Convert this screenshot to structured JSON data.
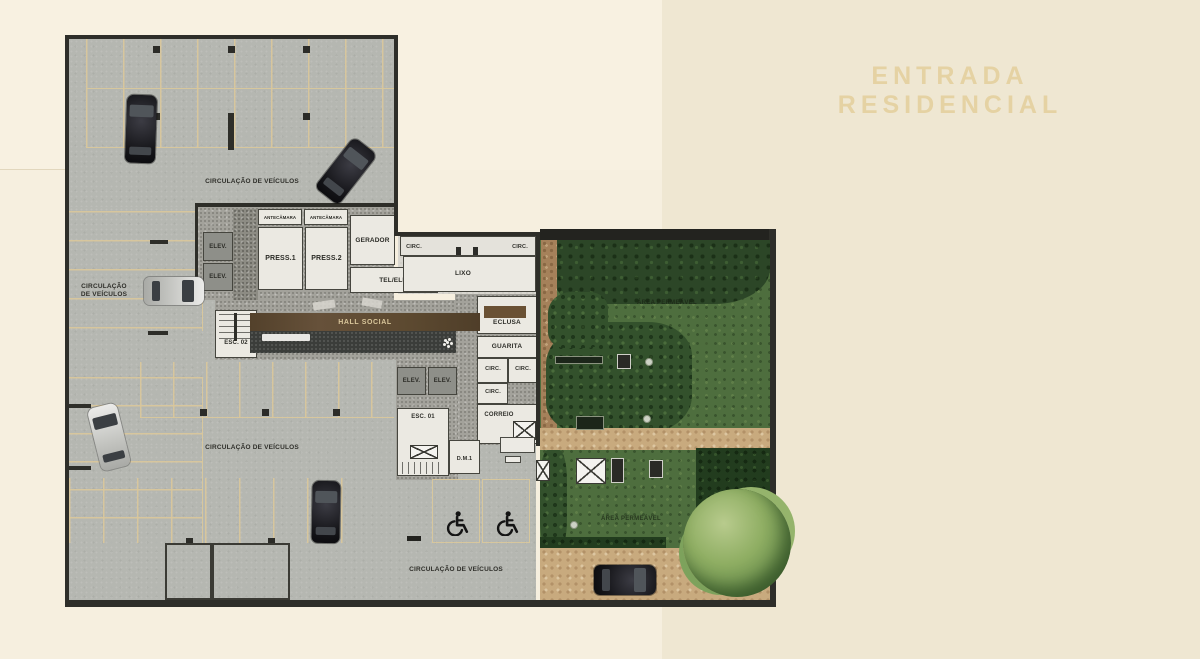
{
  "title": "ENTRADA RESIDENCIAL",
  "labels": {
    "circulacao_veiculos": "CIRCULAÇÃO DE VEÍCULOS",
    "circulacao": "CIRCULAÇÃO",
    "de_veiculos": "DE VEÍCULOS",
    "area_permeavel": "ÁREA PERMEÁVEL"
  },
  "rooms": {
    "elev": "ELEV.",
    "antecamara": "ANTECÂMARA",
    "press1": "PRESS.1",
    "press2": "PRESS.2",
    "gerador": "GERADOR",
    "tel_ele": "TEL/ELE.",
    "circ": "CIRC.",
    "lixo": "LIXO",
    "hall_social": "HALL SOCIAL",
    "esc_02": "ESC. 02",
    "esc_01": "ESC. 01",
    "eclusa": "ECLUSA",
    "guarita": "GUARITA",
    "correio": "CORREIO",
    "dm1": "D.M.1"
  },
  "icons": {
    "wheelchair": "wheelchair-accessible-parking",
    "grate": "crossed-square-grate",
    "mailbox": "crossed-square-mailbox"
  },
  "colors": {
    "background_left": "#f6efdf",
    "background_right": "#efe7d2",
    "title_text": "#e5d2a3",
    "garage_floor": "#b5b7b1",
    "parking_line": "#d9c79c",
    "wall": "#2e2e29",
    "room_floor": "#ebe9e2",
    "granite_floor": "#a3a29b",
    "hall_wood": "#5e4a31",
    "walkway": "#3b3d3a",
    "lawn_green": "#4e6e3e",
    "forest_green": "#2c4627",
    "hedge_green": "#223c1e",
    "tree_green": "#8fae63",
    "sand_path": "#c8aa7e",
    "car_black": "#141418",
    "car_silver": "#d9d9d6"
  }
}
